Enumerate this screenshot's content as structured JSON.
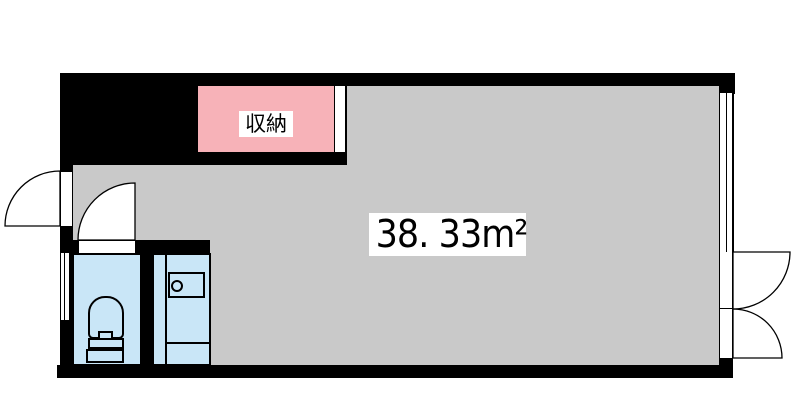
{
  "floorplan": {
    "type": "japanese-room-floorplan",
    "area_label": "38. 33m²",
    "storage_label": "収納",
    "colors": {
      "wall": "#000000",
      "room": "#c9c9c9",
      "storage": "#f7b2b8",
      "water": "#c9e6f7",
      "label_bg": "#ffffff",
      "paper": "#ffffff",
      "text": "#000000",
      "line": "#000000"
    },
    "features": {
      "main_room": "main-room (38.33 sqm, gray)",
      "storage_closet": "storage closet (pink, top)",
      "toilet": "toilet-icon (bottom-left wet area)",
      "kitchenette": "kitchenette-icon with single burner (bottom-left wet area)",
      "entrance_door": "left swing door opening outward",
      "interior_door": "toilet-room door swinging into main room",
      "balcony_doors": "double doors on right wall opening outward",
      "windows": [
        "left-window",
        "right-window"
      ]
    }
  }
}
